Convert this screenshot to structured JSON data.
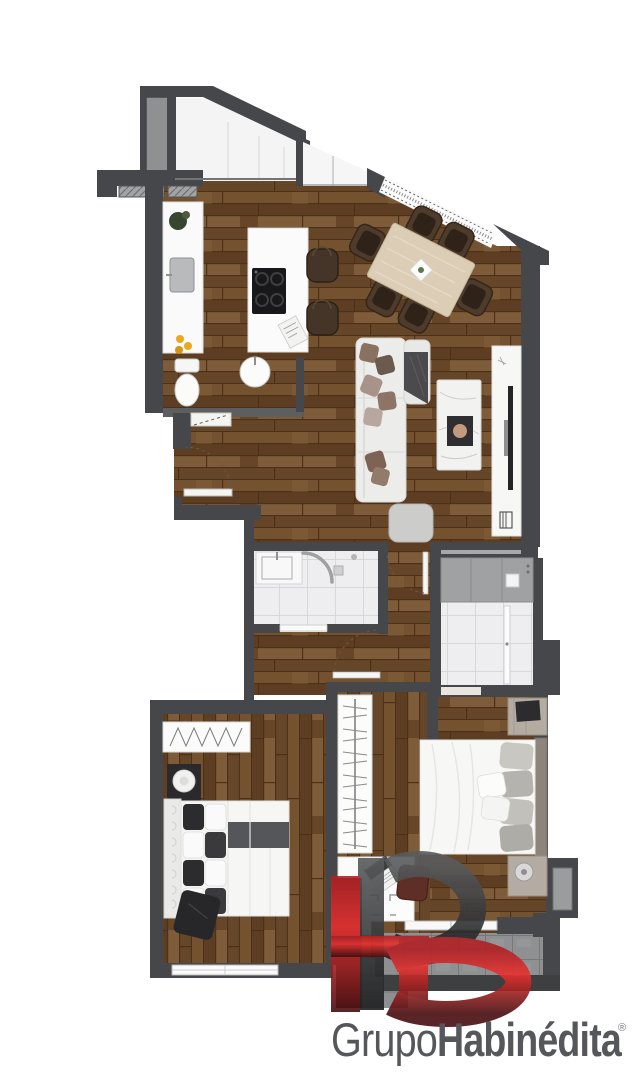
{
  "brand": {
    "monogram": "HB",
    "name_part1": "Grupo",
    "name_part2": "Habinédita",
    "registered_mark": "®",
    "accent_red": "#e2282b",
    "text_gray": "#56575a"
  },
  "palette": {
    "background": "#ffffff",
    "wall": "#46474a",
    "wood_floor": "#6b4a2b",
    "tile_floor": "#eeeef0",
    "balcony_tile": "#8f9092",
    "terrace_floor": "#f4f4f5"
  },
  "floorplan": {
    "type": "apartment-floor-plan-top-view",
    "rooms": [
      {
        "name": "terrace",
        "features": [
          "glass-facade",
          "white-deck"
        ]
      },
      {
        "name": "entry-porch",
        "features": [
          "hatched-landing"
        ]
      },
      {
        "name": "kitchen",
        "features": [
          "counter-with-sink",
          "plant",
          "lemons",
          "island-with-cooktop",
          "two-bar-stools"
        ]
      },
      {
        "name": "dining-area",
        "features": [
          "rotated-table",
          "six-chairs",
          "centerpiece-plate"
        ]
      },
      {
        "name": "living-room",
        "features": [
          "sofa-with-pillows",
          "throw-blanket",
          "marble-coffee-table",
          "tray",
          "pouf",
          "tv-console",
          "tv"
        ]
      },
      {
        "name": "guest-wc",
        "features": [
          "toilet",
          "round-basin",
          "door"
        ]
      },
      {
        "name": "bathroom",
        "features": [
          "vanity-sink",
          "curved-shower-screen",
          "drain",
          "door"
        ]
      },
      {
        "name": "laundry-room",
        "features": [
          "gray-counter",
          "tiled-floor",
          "door"
        ]
      },
      {
        "name": "hall",
        "features": [
          "entry-door-swing",
          "three-door-swings"
        ]
      },
      {
        "name": "hall-closet",
        "features": [
          "hanging-rail",
          "shelf-unit"
        ]
      },
      {
        "name": "bedroom-1",
        "features": [
          "wardrobe-zigzag",
          "lamp-table",
          "checkered-bed",
          "dark-ottoman",
          "window"
        ]
      },
      {
        "name": "bedroom-2",
        "features": [
          "double-bed",
          "two-nightstands",
          "dresser",
          "desk",
          "laptop",
          "red-chair",
          "window"
        ]
      },
      {
        "name": "balcony",
        "features": [
          "gray-tiles",
          "sliding-door"
        ]
      }
    ]
  }
}
